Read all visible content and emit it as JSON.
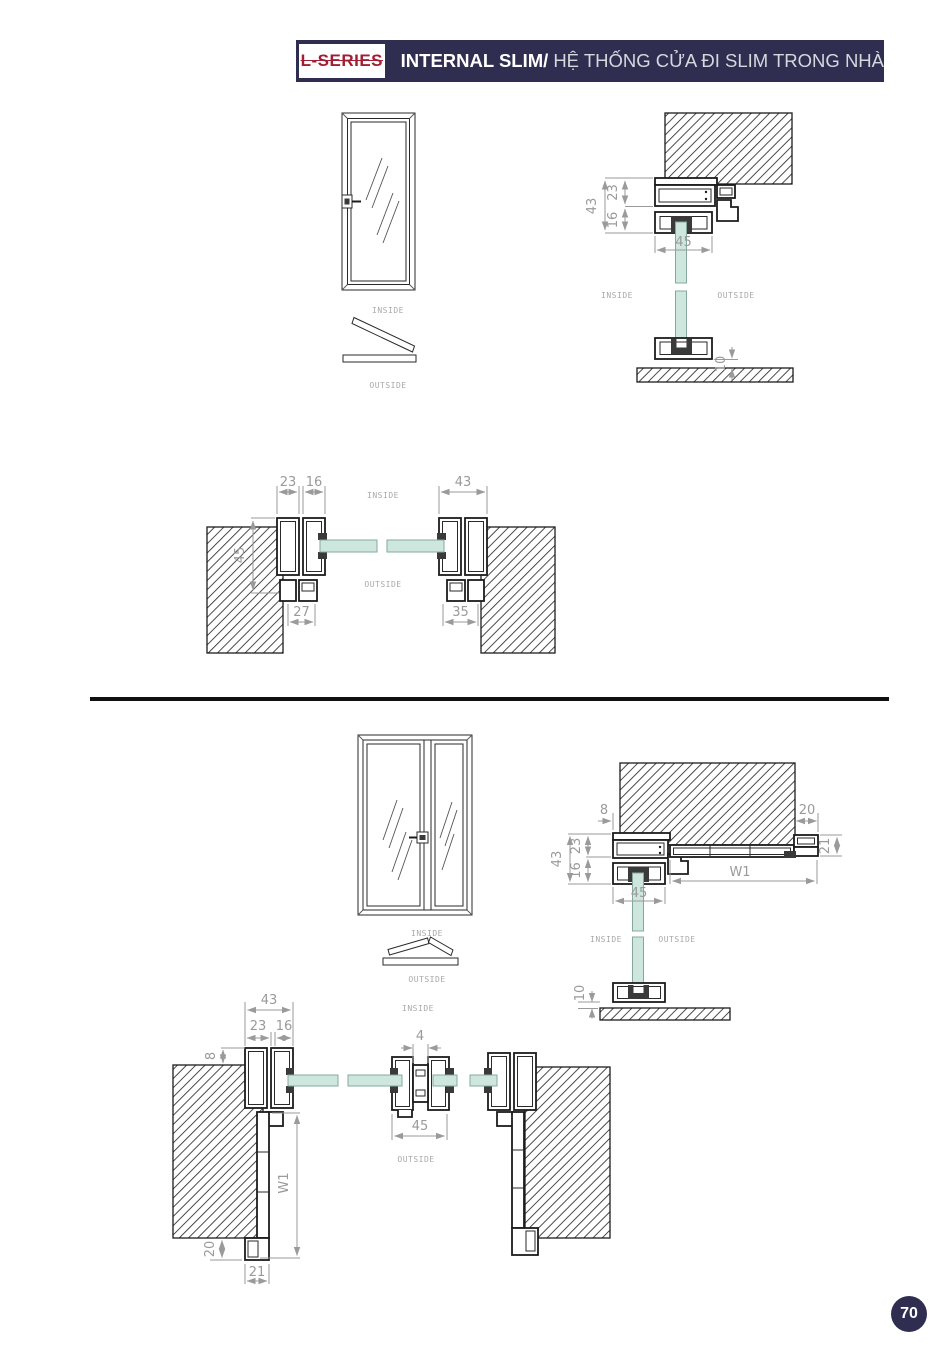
{
  "header": {
    "series": "L-SERIES",
    "title_bold": "INTERNAL SLIM/",
    "title_regular": "HỆ THỐNG CỬA ĐI SLIM TRONG NHÀ"
  },
  "labels": {
    "inside": "INSIDE",
    "outside": "OUTSIDE"
  },
  "page": {
    "number": "70"
  },
  "colors": {
    "navy": "#2f2d50",
    "red": "#a31e35",
    "dimension_gray": "#9a9a9a",
    "glass_green": "#cde7de",
    "line_black": "#1c1c1c"
  },
  "single_door": {
    "vertical_section": {
      "frame_total": "43",
      "frame_top": "23",
      "frame_bottom": "16",
      "leaf_width": "45",
      "floor_gap": "10"
    },
    "horizontal_section": {
      "jamb": "23",
      "leaf": "16",
      "frame_total": "43",
      "depth": "45",
      "arch_left": "27",
      "arch_right": "35"
    }
  },
  "double_door": {
    "vertical_section": {
      "wall_offset": "8",
      "head_end": "20",
      "frame_total": "43",
      "frame_top": "23",
      "frame_bottom": "16",
      "end_height": "21",
      "clear_width": "W1",
      "leaf_width": "45",
      "floor_gap": "10"
    },
    "horizontal_section": {
      "frame_total": "43",
      "jamb": "23",
      "leaf": "16",
      "wall_offset": "8",
      "meeting_gap": "4",
      "leaf_width": "45",
      "clear_width": "W1",
      "arch_offset": "20",
      "arch_width": "21"
    }
  }
}
